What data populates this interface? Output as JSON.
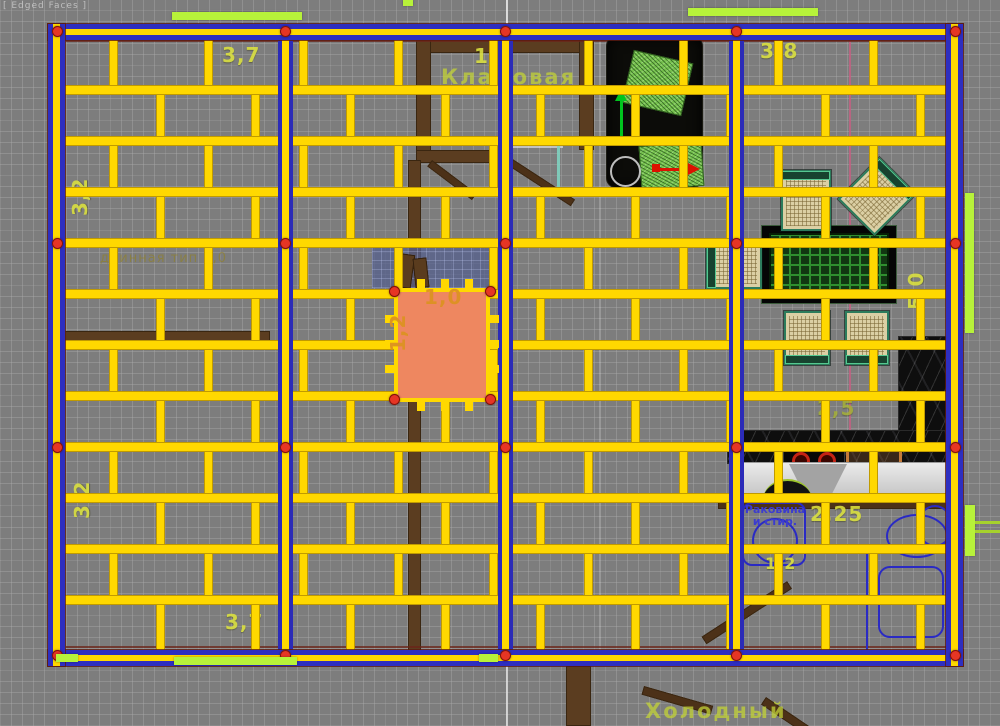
{
  "viewport": {
    "shading_label": "[ Edged Faces ]"
  },
  "rooms": {
    "storage": "Кладовая",
    "cold_porch": "Холодный"
  },
  "kitchen": {
    "sink_note_line1": "Раковина",
    "sink_note_line2": "и стир."
  },
  "labels": [
    {
      "text": "3,7",
      "x": 222,
      "y": 45,
      "rot": 0,
      "cls": "dim",
      "layer": "under",
      "name": "dim-3-7-top"
    },
    {
      "text": "1,8",
      "x": 474,
      "y": 46,
      "rot": 0,
      "cls": "dim",
      "layer": "under",
      "name": "dim-1-8-top"
    },
    {
      "text": "Кладовая",
      "x": 441,
      "y": 66,
      "rot": 0,
      "cls": "room",
      "layer": "under",
      "name": "room-label-storage"
    },
    {
      "text": "3,8",
      "x": 760,
      "y": 41,
      "rot": 0,
      "cls": "dim",
      "layer": "under",
      "name": "dim-3-8-top"
    },
    {
      "text": "3,2",
      "x": 70,
      "y": 216,
      "rot": -90,
      "cls": "dim",
      "layer": "under",
      "name": "dim-3-2-left-upper"
    },
    {
      "text": "3,2",
      "x": 72,
      "y": 519,
      "rot": -90,
      "cls": "dim",
      "layer": "under",
      "name": "dim-3-2-left-lower"
    },
    {
      "text": "5,0",
      "x": 906,
      "y": 310,
      "rot": -90,
      "cls": "dim",
      "layer": "under",
      "name": "dim-5-0-right"
    },
    {
      "text": "2,5",
      "x": 817,
      "y": 398,
      "rot": 0,
      "cls": "dim dim-olive",
      "layer": "under",
      "name": "dim-2-5"
    },
    {
      "text": "2,25",
      "x": 810,
      "y": 504,
      "rot": 0,
      "cls": "dim",
      "layer": "under",
      "name": "dim-2-25"
    },
    {
      "text": "1,2",
      "x": 765,
      "y": 556,
      "rot": 0,
      "cls": "dim dim-small",
      "layer": "under",
      "name": "dim-1-2-kitchen"
    },
    {
      "text": "3,7",
      "x": 225,
      "y": 612,
      "rot": 0,
      "cls": "dim",
      "layer": "under",
      "name": "dim-3-7-bottom"
    },
    {
      "text": "Холодный",
      "x": 645,
      "y": 700,
      "rot": 0,
      "cls": "room",
      "layer": "under",
      "name": "room-label-cold-porch"
    },
    {
      "text": "длинная тип 1,0",
      "x": 100,
      "y": 252,
      "rot": 0,
      "cls": "faint",
      "layer": "under",
      "name": "note-dlinnaya"
    },
    {
      "text": "1,0",
      "x": 424,
      "y": 287,
      "rot": 0,
      "cls": "dim dim-orange",
      "layer": "over",
      "name": "dim-1-0-opening"
    },
    {
      "text": "1,2",
      "x": 388,
      "y": 352,
      "rot": -90,
      "cls": "dim dim-orange",
      "layer": "over",
      "name": "dim-1-2-opening"
    }
  ],
  "plan": {
    "frame": {
      "x": 48,
      "y": 24,
      "w": 915,
      "h": 642
    },
    "inner": {
      "x1": 62,
      "x2": 949,
      "y1": 40,
      "y2": 650
    },
    "beam_rows": [
      85,
      136,
      187,
      238,
      289,
      340,
      391,
      442,
      493,
      544,
      595
    ],
    "stud_cols_a": [
      113,
      208,
      303,
      398,
      493,
      588,
      683,
      778,
      873
    ],
    "stud_cols_b": [
      160,
      255,
      350,
      445,
      540,
      635,
      730,
      825,
      920
    ],
    "blue_posts": [
      285,
      505,
      736
    ],
    "dot_rows": [
      31,
      243,
      447,
      655
    ],
    "dot_cols": [
      57,
      285,
      505,
      736,
      955
    ],
    "anchor_dots": [
      [
        394,
        291
      ],
      [
        490,
        291
      ],
      [
        394,
        399
      ],
      [
        490,
        399
      ]
    ],
    "opening_ticks_x": [
      417,
      441,
      465
    ],
    "opening_ticks_y": [
      315,
      340,
      365
    ],
    "colors": {
      "beam": "#ffd800",
      "post": "#2e2ec0",
      "marker": "#e63524",
      "highlight": "#b7f23a",
      "opening": "#ee8760"
    }
  }
}
